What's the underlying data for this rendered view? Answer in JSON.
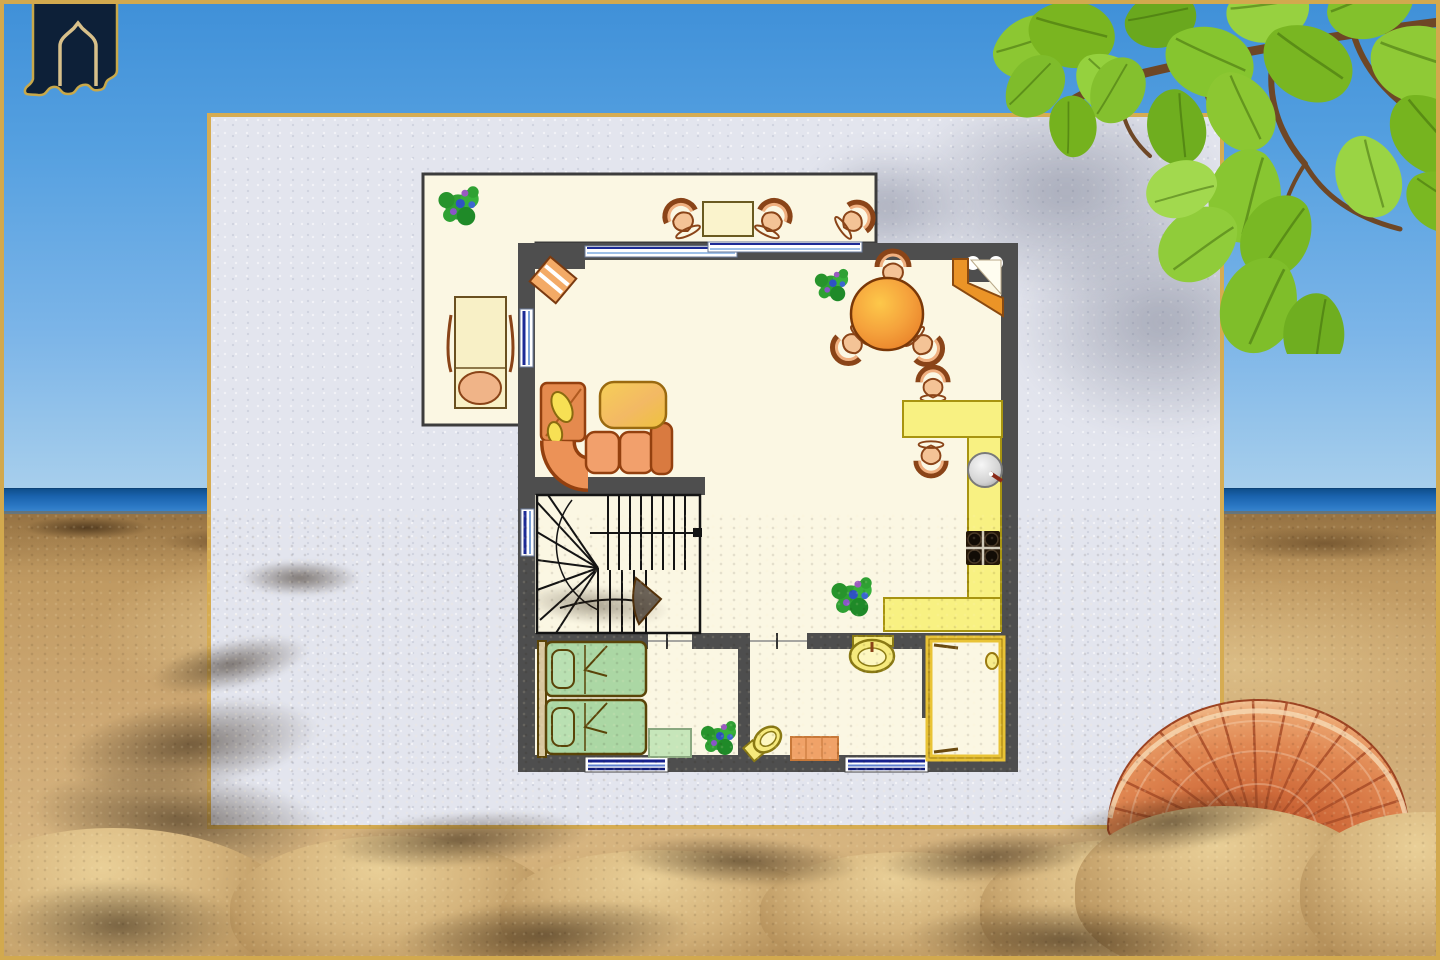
{
  "scene_type": "real-estate floor-plan card composited over a beach photograph",
  "palette": {
    "sky_top": "#3f90d8",
    "sky_bottom": "#a8cfec",
    "sea": "#2d7ac6",
    "sea_dark": "#0f4f8c",
    "sand": "#cda873",
    "sand_light": "#e9cf97",
    "sand_shadow": "#5e3f20",
    "card_fill": "#e3e5ee",
    "card_border_gold": "#d6ac52",
    "frame_gold": "#d2a94e",
    "wall_gray": "#4e4e4e",
    "floor_cream": "#fbf7e3",
    "window_navy": "#18228e",
    "window_light": "#5e7fd0",
    "furniture_orange": "#ec9257",
    "furniture_outline": "#93400f",
    "counter_yellow": "#f8f182",
    "counter_edge": "#a89410",
    "table_pale_yellow": "#faf3cc",
    "bed_green": "#abd7a4",
    "bed_outline": "#5a4408",
    "rug_green": "#c6e6ba",
    "bath_yellow": "#f6ea7c",
    "bath_outline": "#8a7a14",
    "rug_orange": "#f0a268",
    "plant_green": "#2fa133",
    "plant_flower_blue": "#2e52c4",
    "plant_flower_purple": "#9a5ac0",
    "stairs_line": "#141414",
    "leaf_green": "#7fbe2a",
    "branch_brown": "#6e4726",
    "shell_orange": "#df8550",
    "shell_dark": "#b9502a",
    "shell_rim": "#f3c99d",
    "logo_navy": "#0d2038",
    "logo_gold": "#d8c08a"
  },
  "logo": {
    "icon": "house-arch-icon"
  },
  "background": {
    "elements": [
      "sky",
      "sea-horizon",
      "sandy-beach",
      "rocky-sand-ridge",
      "almond-tree-branch-with-leaves",
      "scallop-seashell",
      "foreground-sand-mounds",
      "leaf-shadows-on-card"
    ]
  },
  "card": {
    "content": "ground-floor furniture plan, no text labels"
  },
  "floor_plan": {
    "rooms": [
      {
        "name": "terrace",
        "furniture": [
          "potted-plant",
          "bistro-table",
          "chair",
          "chair",
          "chair",
          "sun-lounger"
        ]
      },
      {
        "name": "living-dining-room",
        "furniture": [
          "entrance-door",
          "corner-sofa",
          "yellow-coffee-table",
          "round-dining-table",
          "dining-chair",
          "dining-chair",
          "dining-chair",
          "corner-cabinet",
          "wall-unit-two-circles",
          "potted-plant"
        ]
      },
      {
        "name": "kitchen",
        "furniture": [
          "breakfast-bar",
          "bar-stool",
          "bar-stool",
          "round-sink",
          "four-burner-cooktop",
          "l-shaped-counter",
          "potted-plant"
        ]
      },
      {
        "name": "staircase",
        "furniture": [
          "u-shaped-stairs",
          "direction-arrow",
          "open-door-leaf"
        ]
      },
      {
        "name": "bedroom",
        "furniture": [
          "single-bed",
          "single-bed",
          "green-rug",
          "potted-plant"
        ]
      },
      {
        "name": "bathroom",
        "furniture": [
          "washbasin",
          "toilet",
          "orange-bath-mat"
        ]
      },
      {
        "name": "shower-room",
        "furniture": [
          "shower-tray",
          "drain"
        ]
      }
    ],
    "window_count": 6,
    "door_opening_count": 4
  }
}
